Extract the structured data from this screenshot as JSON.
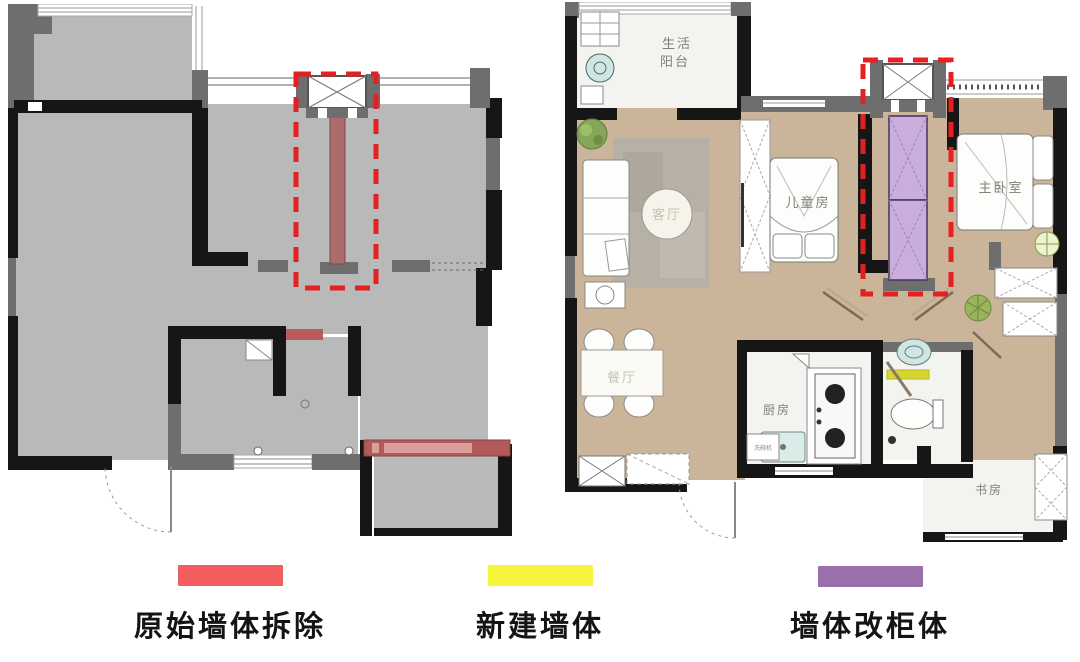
{
  "legend": {
    "items": [
      {
        "id": "demolish-original-wall",
        "label": "原始墙体拆除",
        "color": "#f25e5e"
      },
      {
        "id": "new-wall",
        "label": "新建墙体",
        "color": "#f7f43e"
      },
      {
        "id": "wall-to-cabinet",
        "label": "墙体改柜体",
        "color": "#9a70ac"
      }
    ]
  },
  "right_plan": {
    "rooms": {
      "balcony_line1": "生活",
      "balcony_line2": "阳台",
      "living": "客厅",
      "kids": "儿童房",
      "master": "主卧室",
      "dining": "餐厅",
      "kitchen": "厨房",
      "dishwasher": "洗碗机",
      "study": "书房"
    }
  },
  "colors": {
    "highlight_dashed_box": "#e52020",
    "demolition_wall_fill": "#aa6c6c",
    "new_wall_yellow": "#d6d633",
    "cabinet_purple_fill": "#c9addc",
    "floor_concrete": "#b9b9b9",
    "floor_wood": "#cbb59a",
    "wall_black": "#161616",
    "wall_gray": "#6e6e6e"
  }
}
